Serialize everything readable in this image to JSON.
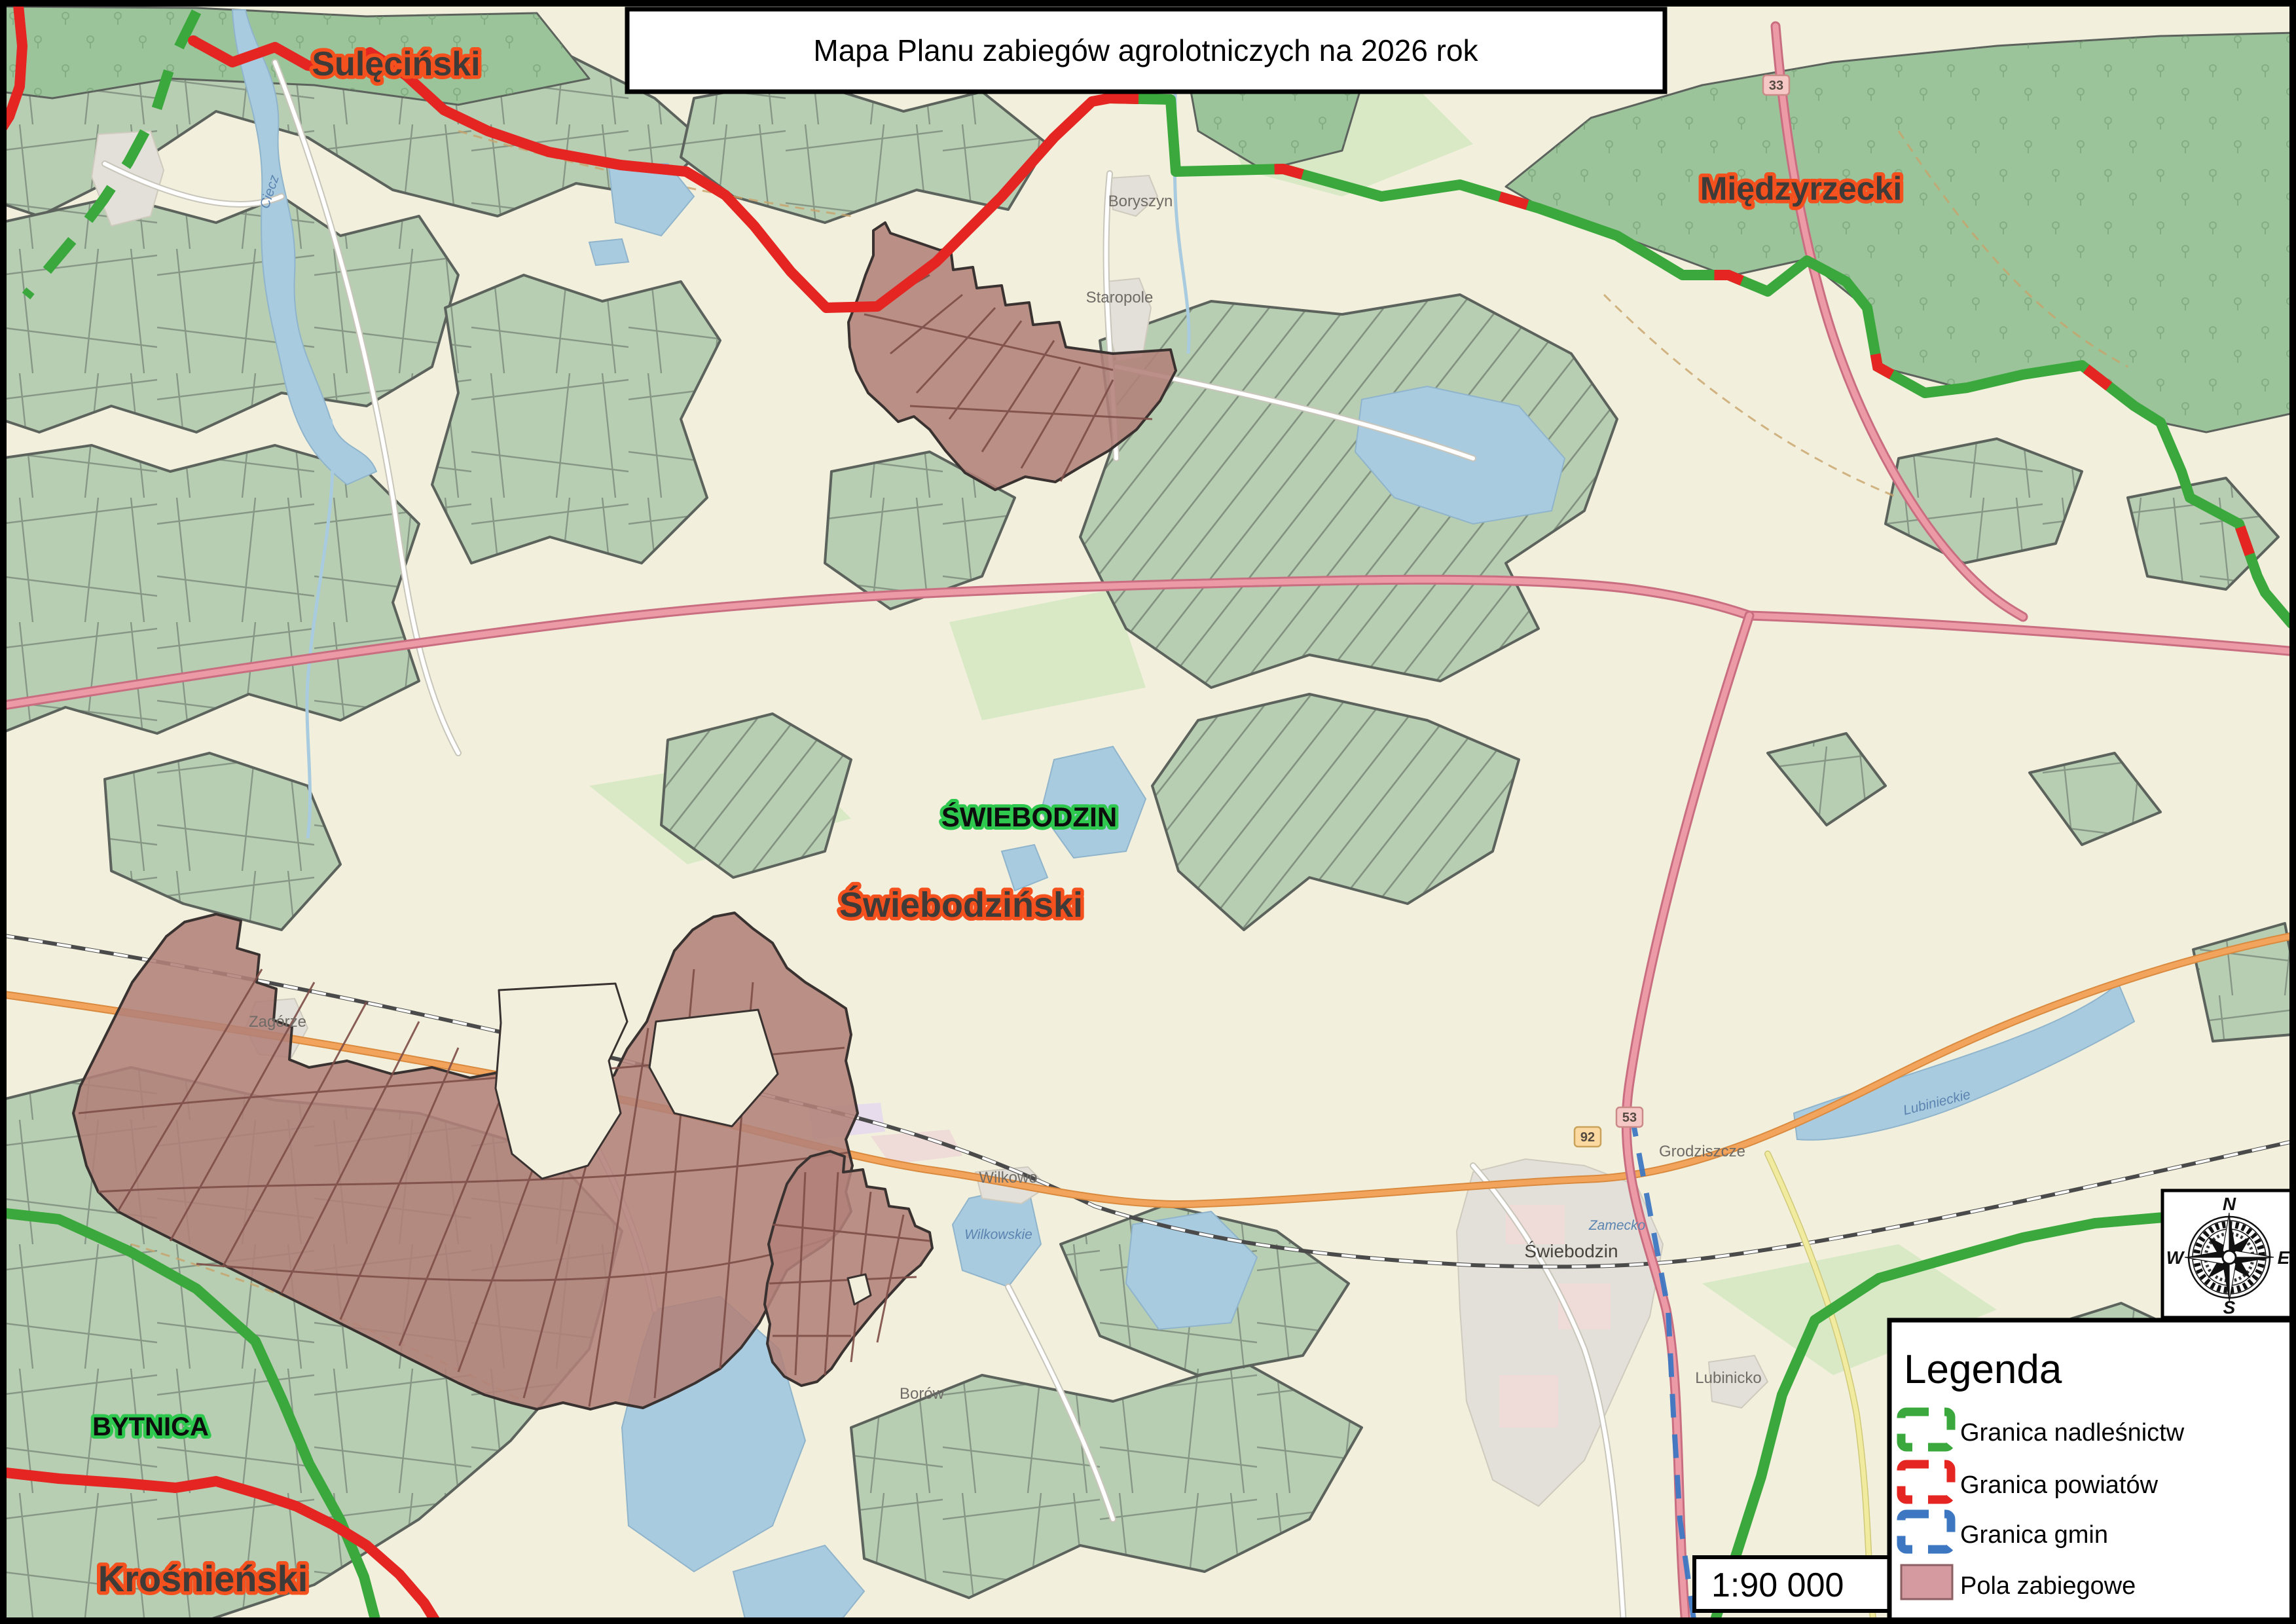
{
  "title": {
    "text": "Mapa Planu zabiegów agrolotniczych na 2026 rok"
  },
  "scale_bar": {
    "text": "1:90 000"
  },
  "legend": {
    "title": "Legenda",
    "items": [
      {
        "label": "Granica nadleśnictw",
        "color": "#3aa83c",
        "style": "dashed-outline"
      },
      {
        "label": "Granica powiatów",
        "color": "#e42521",
        "style": "dashed-outline"
      },
      {
        "label": "Granica  gmin",
        "color": "#3d77c2",
        "style": "dashed-outline"
      },
      {
        "label": "Pola zabiegowe",
        "color": "#d59aa0",
        "style": "filled",
        "border_color": "#8c5f63"
      }
    ]
  },
  "compass": {
    "north": "N",
    "east": "E",
    "south": "S",
    "west": "W"
  },
  "region_labels": {
    "powiaty": [
      {
        "text": "Sulęciński"
      },
      {
        "text": "Międzyrzecki"
      },
      {
        "text": "Świebodziński"
      },
      {
        "text": "Krośnieński"
      }
    ],
    "towns": [
      {
        "text": "ŚWIEBODZIN"
      },
      {
        "text": "BYTNICA"
      }
    ]
  },
  "place_labels": [
    "Boryszyn",
    "Staropole",
    "Zagórze",
    "Wilkowo",
    "Grodziszcze",
    "Lubinicko",
    "Borów",
    "Świebodzin"
  ],
  "water_labels": [
    "Ciecz",
    "Wilkowskie",
    "Lubinieckie",
    "Zamecko"
  ],
  "road_shields": [
    "92",
    "53",
    "33"
  ],
  "map_colors": {
    "background": "#f2f0dc",
    "forest": "#b7ceb2",
    "dense_forest": "#9cc49a",
    "water": "#a9cbdf",
    "treatment_fields": "#b28179",
    "granica_nadlesnictw": "#3aa83c",
    "granica_powiatow": "#e42521",
    "granica_gmin": "#3d77c2",
    "road_major": "#e08b9b",
    "road_secondary": "#f2a45c"
  }
}
